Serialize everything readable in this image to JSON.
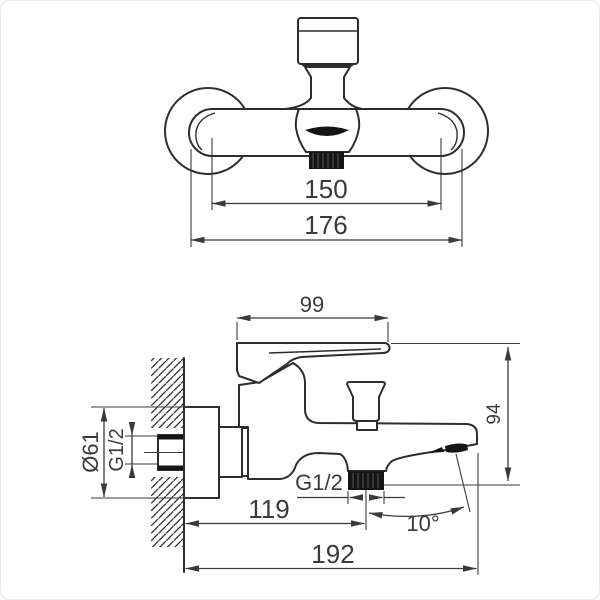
{
  "drawing": {
    "type": "technical-dimension-drawing",
    "subject": "wall-mounted bath shower mixer faucet, front and side views",
    "units": "mm",
    "line_color": "#2d2d2d",
    "dimension_color": "#3a3a3a",
    "front_view": {
      "dims": [
        {
          "name": "mounting-hole-spacing",
          "label": "150"
        },
        {
          "name": "body-overall-width",
          "label": "176"
        }
      ]
    },
    "side_view": {
      "dims": [
        {
          "name": "lever-length",
          "label": "99"
        },
        {
          "name": "overall-height",
          "label": "94"
        },
        {
          "name": "escutcheon-diameter",
          "label": "Ø61"
        },
        {
          "name": "wall-inlet-thread",
          "label": "G1/2"
        },
        {
          "name": "shower-outlet-thread",
          "label": "G1/2"
        },
        {
          "name": "wall-to-outlet-distance",
          "label": "119"
        },
        {
          "name": "overall-projection",
          "label": "192"
        },
        {
          "name": "spout-angle",
          "label": "10°"
        }
      ]
    }
  }
}
